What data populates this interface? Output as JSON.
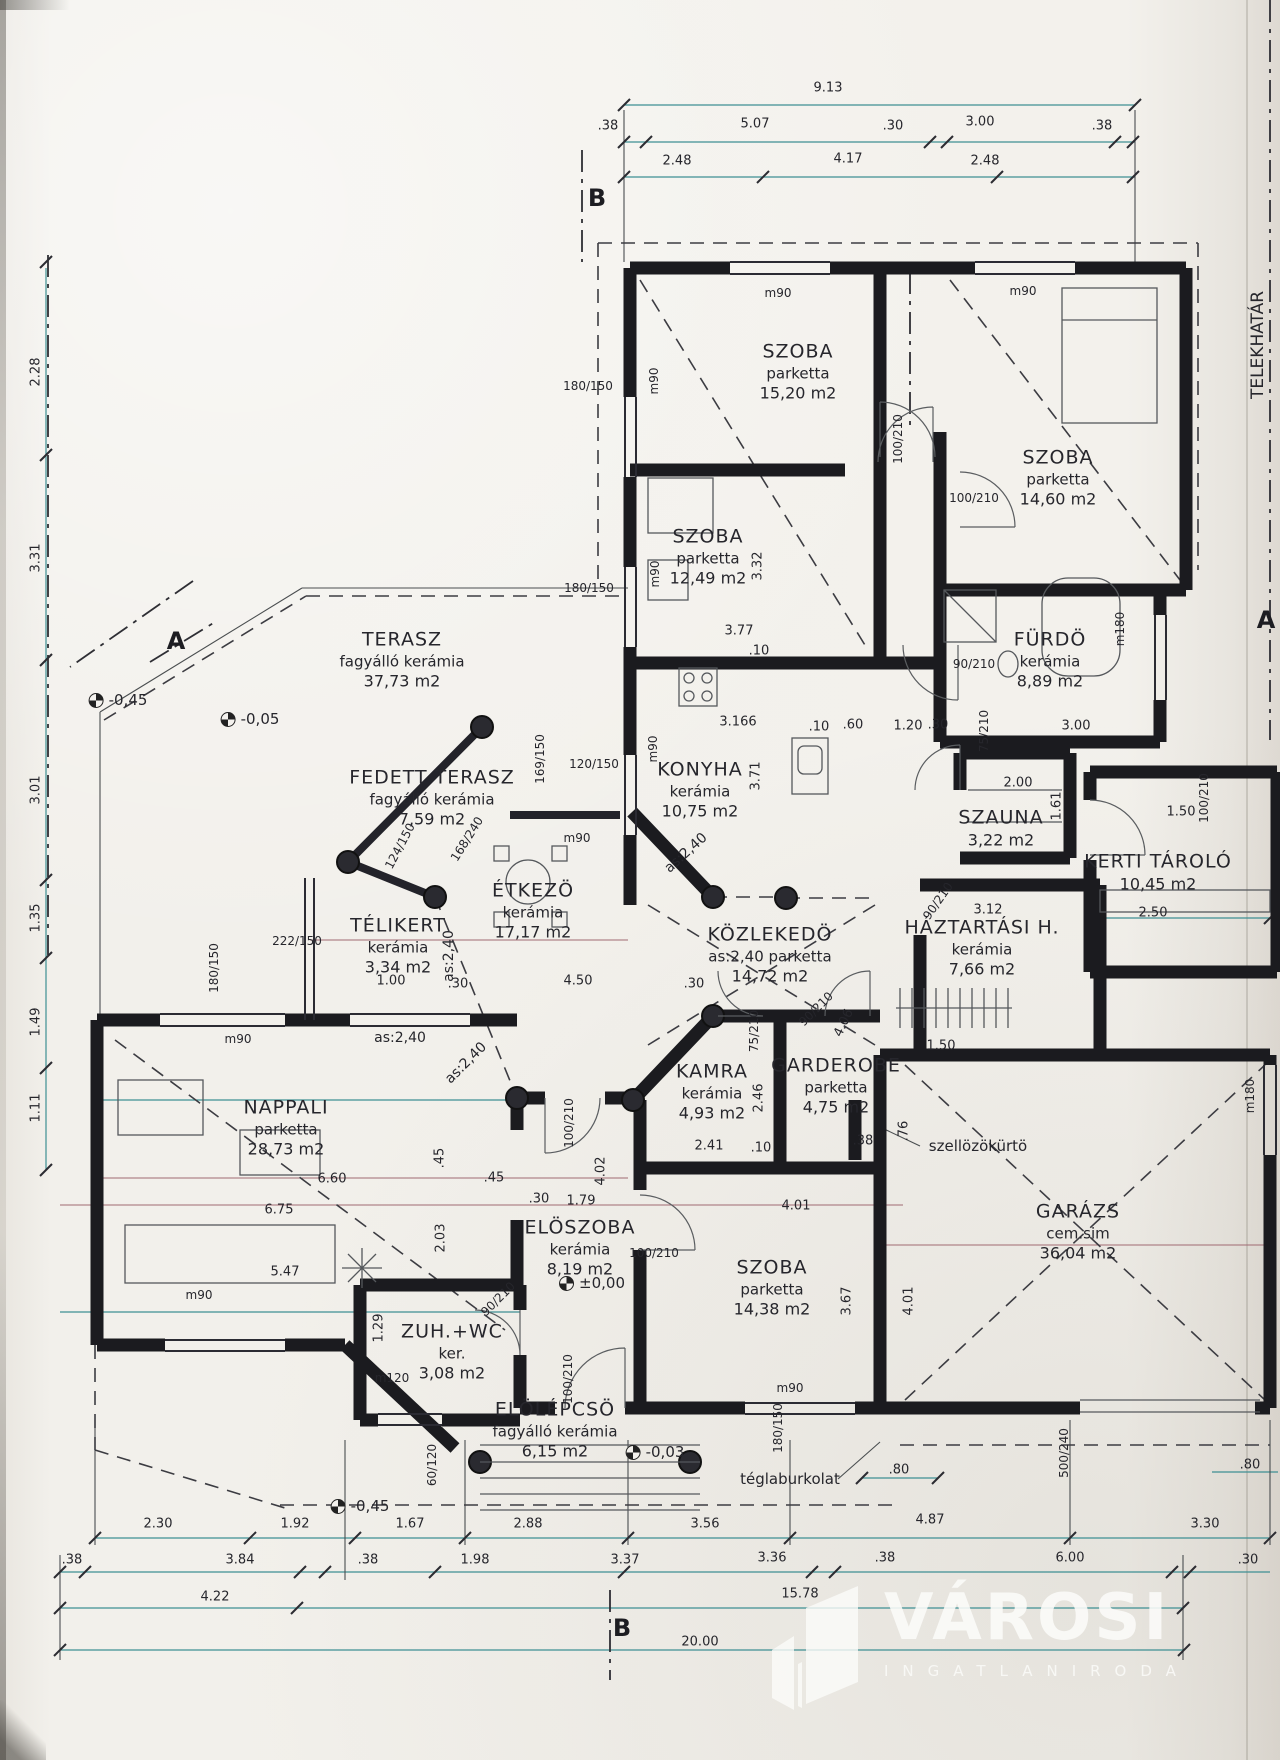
{
  "logo": {
    "name": "VÁROSI",
    "subtitle": "INGATLANIRODA"
  },
  "boundary_label": "TELEKHATÁR",
  "rooms": [
    {
      "n": "SZOBA",
      "f": "parketta",
      "a": "15,20 m2",
      "x": 798,
      "y": 372
    },
    {
      "n": "SZOBA",
      "f": "parketta",
      "a": "14,60 m2",
      "x": 1058,
      "y": 478
    },
    {
      "n": "SZOBA",
      "f": "parketta",
      "a": "12,49 m2",
      "x": 708,
      "y": 557
    },
    {
      "n": "FÜRDÖ",
      "f": "kerámia",
      "a": "8,89 m2",
      "x": 1050,
      "y": 660
    },
    {
      "n": "TERASZ",
      "f": "fagyálló kerámia",
      "a": "37,73 m2",
      "x": 402,
      "y": 660
    },
    {
      "n": "FEDETT TERASZ",
      "f": "fagyálló kerámia",
      "a": "7,59 m2",
      "x": 432,
      "y": 798
    },
    {
      "n": "KONYHA",
      "f": "kerámia",
      "a": "10,75 m2",
      "x": 700,
      "y": 790
    },
    {
      "n": "SZAUNA",
      "f": "",
      "a": "3,22 m2",
      "x": 1001,
      "y": 828
    },
    {
      "n": "KERTI TÁROLÓ",
      "f": "",
      "a": "10,45 m2",
      "x": 1158,
      "y": 872
    },
    {
      "n": "ÉTKEZÖ",
      "f": "kerámia",
      "a": "17,17 m2",
      "x": 533,
      "y": 911
    },
    {
      "n": "TÉLIKERT",
      "f": "kerámia",
      "a": "3,34 m2",
      "x": 398,
      "y": 946
    },
    {
      "n": "KÖZLEKEDÖ",
      "f": "as:2,40 parketta",
      "a": "14,72 m2",
      "x": 770,
      "y": 955
    },
    {
      "n": "HÁZTARTÁSI H.",
      "f": "kerámia",
      "a": "7,66 m2",
      "x": 982,
      "y": 948
    },
    {
      "n": "NAPPALI",
      "f": "parketta",
      "a": "28,73 m2",
      "x": 286,
      "y": 1128
    },
    {
      "n": "KAMRA",
      "f": "kerámia",
      "a": "4,93 m2",
      "x": 712,
      "y": 1092
    },
    {
      "n": "GARDEROBE",
      "f": "parketta",
      "a": "4,75 m2",
      "x": 836,
      "y": 1086
    },
    {
      "n": "ELÖSZOBA",
      "f": "kerámia",
      "a": "8,19 m2",
      "x": 580,
      "y": 1248
    },
    {
      "n": "SZOBA",
      "f": "parketta",
      "a": "14,38 m2",
      "x": 772,
      "y": 1288
    },
    {
      "n": "GARÁZS",
      "f": "cem.sim",
      "a": "36,04 m2",
      "x": 1078,
      "y": 1232
    },
    {
      "n": "ZUH.+WC",
      "f": "ker.",
      "a": "3,08 m2",
      "x": 452,
      "y": 1352
    },
    {
      "n": "ELÖLÉPCSÖ",
      "f": "fagyálló kerámia",
      "a": "6,15 m2",
      "x": 555,
      "y": 1430
    }
  ],
  "labels": [
    [
      "9.13",
      828,
      88
    ],
    [
      ".38",
      608,
      126
    ],
    [
      "5.07",
      755,
      124
    ],
    [
      ".30",
      893,
      126
    ],
    [
      "3.00",
      980,
      122
    ],
    [
      ".38",
      1102,
      126
    ],
    [
      "2.48",
      677,
      161
    ],
    [
      "4.17",
      848,
      159
    ],
    [
      "2.48",
      985,
      161
    ],
    [
      "2.28",
      36,
      372,
      -90
    ],
    [
      "3.31",
      36,
      558,
      -90
    ],
    [
      "3.01",
      36,
      790,
      -90
    ],
    [
      "1.35",
      36,
      918,
      -90
    ],
    [
      "1.49",
      36,
      1022,
      -90
    ],
    [
      "1.11",
      36,
      1108,
      -90
    ],
    [
      "2.30",
      158,
      1524
    ],
    [
      "1.92",
      295,
      1524
    ],
    [
      "1.67",
      410,
      1524
    ],
    [
      "2.88",
      528,
      1524
    ],
    [
      "3.56",
      705,
      1524
    ],
    [
      "4.87",
      930,
      1520
    ],
    [
      "3.30",
      1205,
      1524
    ],
    [
      ".38",
      72,
      1560
    ],
    [
      "3.84",
      240,
      1560
    ],
    [
      ".38",
      368,
      1560
    ],
    [
      "1.98",
      475,
      1560
    ],
    [
      "3.37",
      625,
      1560
    ],
    [
      "3.36",
      772,
      1558
    ],
    [
      ".38",
      885,
      1558
    ],
    [
      "6.00",
      1070,
      1558
    ],
    [
      ".30",
      1248,
      1560
    ],
    [
      "4.22",
      215,
      1597
    ],
    [
      "15.78",
      800,
      1594
    ],
    [
      "20.00",
      700,
      1642
    ],
    [
      "m90",
      778,
      293,
      0,
      12
    ],
    [
      "m90",
      1023,
      291,
      0,
      12
    ],
    [
      "m90",
      654,
      381,
      -90,
      12
    ],
    [
      "m90",
      655,
      574,
      -90,
      12
    ],
    [
      "m90",
      653,
      749,
      -90,
      12
    ],
    [
      "m90",
      577,
      838,
      0,
      12
    ],
    [
      "m90",
      238,
      1039,
      0,
      12
    ],
    [
      "m90",
      199,
      1295,
      0,
      12
    ],
    [
      "m90",
      790,
      1388,
      0,
      12
    ],
    [
      "180/150",
      588,
      386,
      0,
      12
    ],
    [
      "180/150",
      589,
      588,
      0,
      12
    ],
    [
      "120/150",
      594,
      764,
      0,
      12
    ],
    [
      "169/150",
      540,
      759,
      -90,
      12
    ],
    [
      "124/150",
      400,
      846,
      -62,
      12
    ],
    [
      "168/240",
      467,
      839,
      -58,
      12
    ],
    [
      "222/150",
      297,
      941,
      0,
      12
    ],
    [
      "180/150",
      214,
      968,
      -90,
      12
    ],
    [
      "180/150",
      778,
      1428,
      -90,
      12
    ],
    [
      "m180",
      1120,
      629,
      -90,
      12
    ],
    [
      "m180",
      1250,
      1096,
      -90,
      12
    ],
    [
      "m120",
      392,
      1378,
      0,
      12
    ],
    [
      "100/210",
      898,
      439,
      -90,
      12
    ],
    [
      "100/210",
      974,
      498,
      0,
      12
    ],
    [
      "90/210",
      974,
      664,
      0,
      12
    ],
    [
      "75/210",
      984,
      731,
      -90,
      12
    ],
    [
      "90/210",
      938,
      901,
      -55,
      12
    ],
    [
      "100/210",
      1204,
      798,
      -90,
      12
    ],
    [
      "90/210",
      816,
      1009,
      -45,
      12
    ],
    [
      "75/210",
      754,
      1031,
      -90,
      12
    ],
    [
      "100/210",
      569,
      1123,
      -90,
      12
    ],
    [
      "100/210",
      654,
      1253,
      0,
      12
    ],
    [
      "90/210",
      498,
      1299,
      -45,
      12
    ],
    [
      "100/210",
      568,
      1379,
      -90,
      12
    ],
    [
      "500/240",
      1064,
      1453,
      -90,
      12
    ],
    [
      "60/120",
      432,
      1465,
      -90,
      12
    ],
    [
      "3.32",
      758,
      566,
      -90
    ],
    [
      "3.77",
      739,
      631
    ],
    [
      ".10",
      759,
      651
    ],
    [
      "3.166",
      738,
      722
    ],
    [
      ".10",
      819,
      727
    ],
    [
      ".60",
      853,
      725
    ],
    [
      "1.20",
      908,
      726
    ],
    [
      ".30",
      938,
      725
    ],
    [
      "3.00",
      1076,
      726
    ],
    [
      "3.71",
      756,
      776,
      -90
    ],
    [
      "2.00",
      1018,
      783
    ],
    [
      "1.61",
      1057,
      806,
      -90
    ],
    [
      "3.12",
      988,
      910
    ],
    [
      "1.50",
      941,
      1046
    ],
    [
      ".76",
      904,
      1131,
      -90
    ],
    [
      ".38",
      863,
      1141
    ],
    [
      "2.41",
      709,
      1146
    ],
    [
      ".10",
      761,
      1148
    ],
    [
      "4.01",
      796,
      1206
    ],
    [
      "4.02",
      601,
      1171,
      -90
    ],
    [
      "1.79",
      581,
      1201
    ],
    [
      ".30",
      539,
      1199
    ],
    [
      "2.03",
      441,
      1238,
      -90
    ],
    [
      ".45",
      440,
      1158,
      -90
    ],
    [
      ".45",
      494,
      1178
    ],
    [
      "6.60",
      332,
      1179
    ],
    [
      "6.75",
      279,
      1210
    ],
    [
      "5.47",
      285,
      1272
    ],
    [
      "1.29",
      379,
      1328,
      -90
    ],
    [
      "2.46",
      759,
      1098,
      -90
    ],
    [
      "4.06",
      844,
      1023,
      -65
    ],
    [
      ".30",
      694,
      984
    ],
    [
      "4.50",
      578,
      981
    ],
    [
      "1.00",
      391,
      981
    ],
    [
      ".30",
      458,
      984
    ],
    [
      "3.67",
      847,
      1301,
      -90
    ],
    [
      "4.01",
      909,
      1301,
      -90
    ],
    [
      "2.50",
      1153,
      913
    ],
    [
      "1.50",
      1181,
      812
    ],
    [
      ".80",
      899,
      1470
    ],
    [
      ".80",
      1250,
      1465
    ],
    [
      "as:2,40",
      400,
      1038,
      0,
      14
    ],
    [
      "as:2,40",
      449,
      956,
      -90,
      14
    ],
    [
      "as:2,40",
      466,
      1063,
      -45,
      14
    ],
    [
      "as:2,40",
      686,
      853,
      -42,
      14
    ],
    [
      "szellözökürtö",
      978,
      1146,
      0,
      15
    ],
    [
      "téglaburkolat",
      790,
      1479,
      0,
      15
    ],
    [
      "TELEKHATÁR",
      1258,
      345,
      -90,
      17
    ]
  ],
  "elevation_marks": [
    [
      "-0,45",
      118,
      700
    ],
    [
      "-0,05",
      250,
      719
    ],
    [
      "±0,00",
      592,
      1283
    ],
    [
      "-0,03",
      655,
      1452
    ],
    [
      "-0,45",
      360,
      1506
    ]
  ],
  "section_marks": [
    [
      "B",
      597,
      198
    ],
    [
      "B",
      622,
      1628
    ],
    [
      "A",
      176,
      641
    ],
    [
      "A",
      1266,
      620
    ]
  ]
}
